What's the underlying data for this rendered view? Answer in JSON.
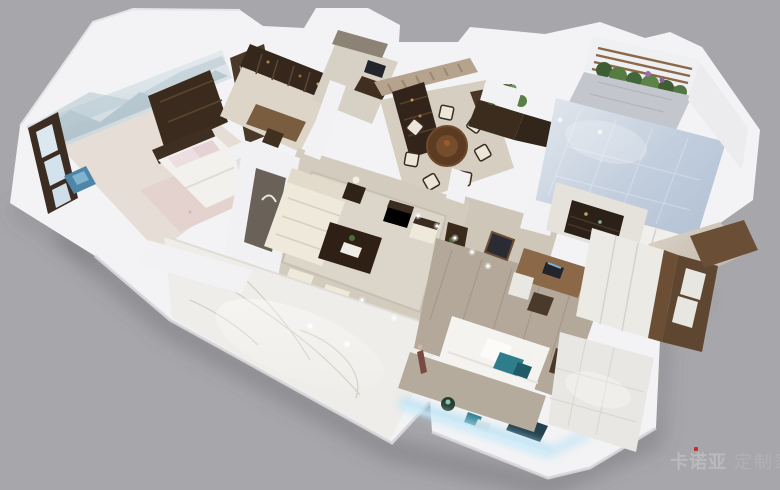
{
  "meta": {
    "content_type": "3d-dollhouse-apartment-render",
    "background_color": "#a7a7ab"
  },
  "watermark": {
    "brand": "卡诺亚",
    "suffix": "定制家",
    "accent_color": "#c5281c",
    "text_color": "#b7b7b9"
  },
  "palette": {
    "outer_wall_white": "#f3f3f5",
    "marble_floor": "#efede9",
    "marble_vein": "#ccc8c0",
    "wood_dark": "#43311f",
    "wood_mid": "#6b4e33",
    "floor_beige": "#d5cec1",
    "rug_beige": "#dcd6ca",
    "sofa_cream": "#efe9dc",
    "tile_blue": "#c2cedd",
    "tile_white": "#e9e7e3",
    "plank_gray_wood": "#b3a899",
    "plant_green": "#4c6b3a",
    "accent_teal": "#2e7d8a",
    "led_glow_blue": "#a8dcf4",
    "mural_blue_gray": "#c6d3da",
    "curtain_tan": "#b5a38e",
    "shadow_gray": "#55555c"
  }
}
